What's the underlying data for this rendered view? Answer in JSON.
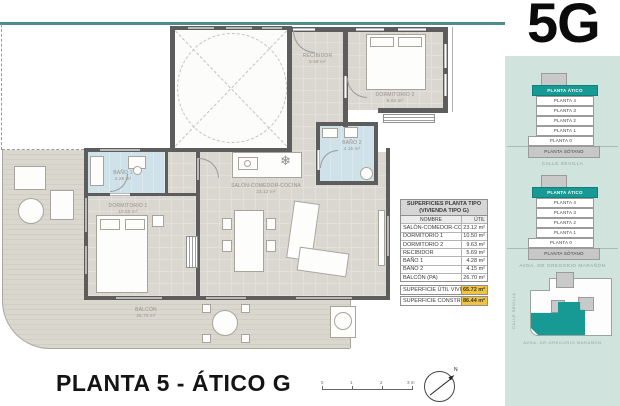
{
  "header": {
    "unit_code": "5G"
  },
  "plan": {
    "title": "PLANTA 5 - ÁTICO G",
    "north_label": "N",
    "scale_labels": [
      "0",
      "1",
      "2",
      "3 m"
    ],
    "rooms": [
      {
        "name": "SALÓN-COMEDOR-COCINA",
        "area": "23.12 m²"
      },
      {
        "name": "DORMITORIO 1",
        "area": "10.50 m²"
      },
      {
        "name": "DORMITORIO 2",
        "area": "9.63 m²"
      },
      {
        "name": "RECIBIDOR",
        "area": "5.69 m²"
      },
      {
        "name": "BAÑO 1",
        "area": "4.28 m²"
      },
      {
        "name": "BAÑO 2",
        "area": "4.15 m²"
      },
      {
        "name": "BALCÓN",
        "area": "26.70 m²"
      }
    ]
  },
  "areas_table": {
    "title_line1": "SUPERFICIES PLANTA TIPO",
    "title_line2": "(VIVIENDA TIPO G)",
    "columns": {
      "name": "NOMBRE",
      "util": "ÚTIL"
    },
    "rows": [
      {
        "name": "SALÓN-COMEDOR-COCINA",
        "util": "23.12 m²"
      },
      {
        "name": "DORMITORIO 1",
        "util": "10.50 m²"
      },
      {
        "name": "DORMITORIO 2",
        "util": "9.63 m²"
      },
      {
        "name": "RECIBIDOR",
        "util": "5.69 m²"
      },
      {
        "name": "BAÑO 1",
        "util": "4.28 m²"
      },
      {
        "name": "BAÑO 2",
        "util": "4.15 m²"
      },
      {
        "name": "BALCÓN (PA)",
        "util": "26.70 m²"
      }
    ],
    "summary": [
      {
        "name": "SUPERFICIE ÚTIL VIVIENDA",
        "value": "65.72 m²"
      },
      {
        "name": "SUPERFICIE CONSTRUIDA",
        "value": "86.44 m²"
      }
    ]
  },
  "sidebar": {
    "stacks": [
      {
        "levels": [
          "PLANTA ÁTICO",
          "PLANTA 4",
          "PLANTA 3",
          "PLANTA 2",
          "PLANTA 1",
          "PLANTA 0",
          "PLANTA SÓTANO"
        ],
        "caption": "CALLE SEVILLA"
      },
      {
        "levels": [
          "PLANTA ÁTICO",
          "PLANTA 4",
          "PLANTA 3",
          "PLANTA 2",
          "PLANTA 1",
          "PLANTA 0",
          "PLANTA SÓTANO"
        ],
        "caption": "AVDA. DR GREGORIO MARAÑÓN"
      }
    ],
    "siteplan": {
      "street_left": "CALLE SEVILLA",
      "street_bottom": "AVDA. DR GREGORIO MARAÑÓN"
    }
  },
  "colors": {
    "accent_teal": "#189a94",
    "sidebar_bg": "#d0e4dd",
    "highlight_yellow": "#f2c33c",
    "wall_gray": "#5d5d5d",
    "bath_blue": "#cfe1e9",
    "floor_gray": "#dad7d0"
  }
}
